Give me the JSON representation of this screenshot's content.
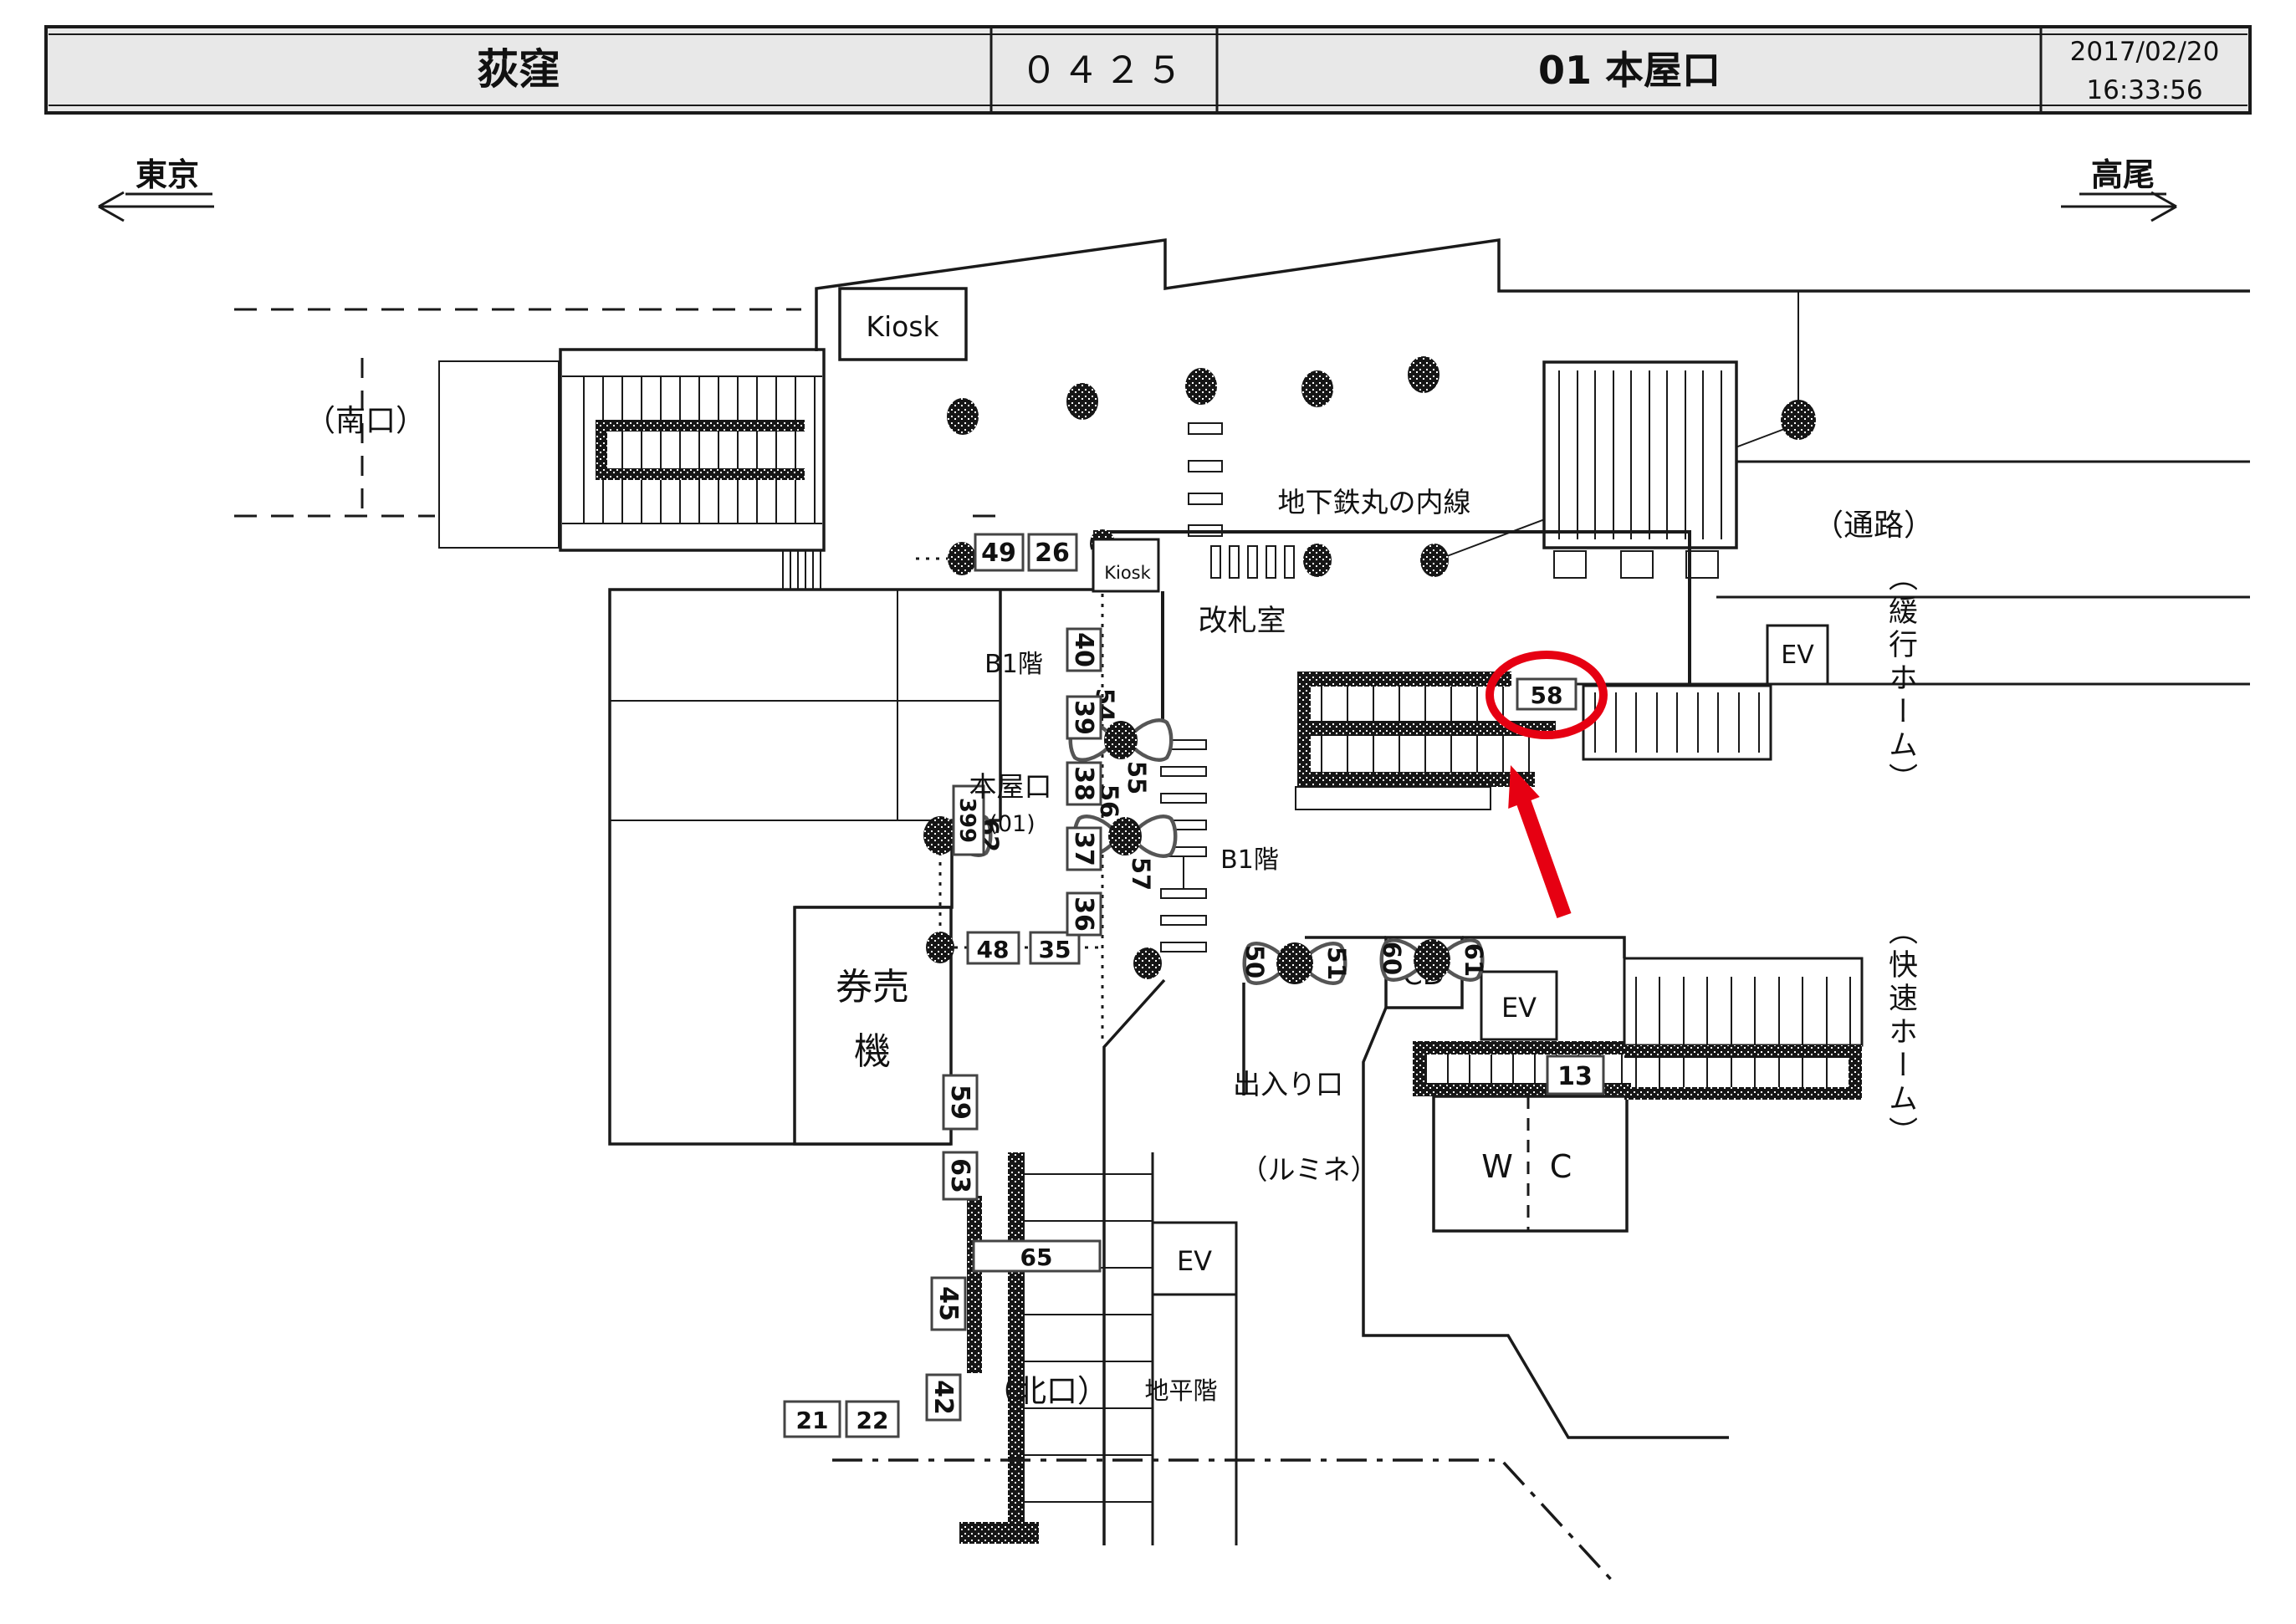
{
  "header": {
    "station_name": "荻窪",
    "station_code": "０４２５",
    "view_name": "01 本屋口",
    "date": "2017/02/20",
    "time": "16:33:56"
  },
  "directions": {
    "west": "東京",
    "east": "高尾"
  },
  "labels": {
    "south_exit": "（南口）",
    "passage": "（通路）",
    "metro_line": "地下鉄丸の内線",
    "kiosk_upper": "Kiosk",
    "kiosk_concourse": "Kiosk",
    "gate_office": "改札室",
    "b1_west": "B1階",
    "b1_center": "B1階",
    "b1_south": "B1階",
    "main_gate_name": "本屋口",
    "main_gate_code": "(01)",
    "ticket_machines_line1": "券売",
    "ticket_machines_line2": "機",
    "doorway": "出入り口",
    "lumine": "（ルミネ）",
    "wc_left": "W",
    "wc_right": "C",
    "cd": "CD",
    "ev": "EV",
    "north_exit": "（北口）",
    "ground_floor": "地平階",
    "local_platform": "（緩行ホーム）",
    "rapid_platform": "（快速ホーム）"
  },
  "cameras": {
    "c13": "13",
    "c21": "21",
    "c22": "22",
    "c26": "26",
    "c35": "35",
    "c36": "36",
    "c37": "37",
    "c38": "38",
    "c39": "39",
    "c40": "40",
    "c42": "42",
    "c45": "45",
    "c48": "48",
    "c49": "49",
    "c50": "50",
    "c51": "51",
    "c54": "54",
    "c55": "55",
    "c56": "56",
    "c57": "57",
    "c58": "58",
    "c59": "59",
    "c60": "60",
    "c61": "61",
    "c62": "62",
    "c63": "63",
    "c65": "65",
    "c399": "399"
  },
  "highlight": {
    "camera": "58"
  },
  "colors": {
    "header_bg": "#e8e8e8",
    "line": "#1a1a1a",
    "accent_red": "#e60012"
  }
}
